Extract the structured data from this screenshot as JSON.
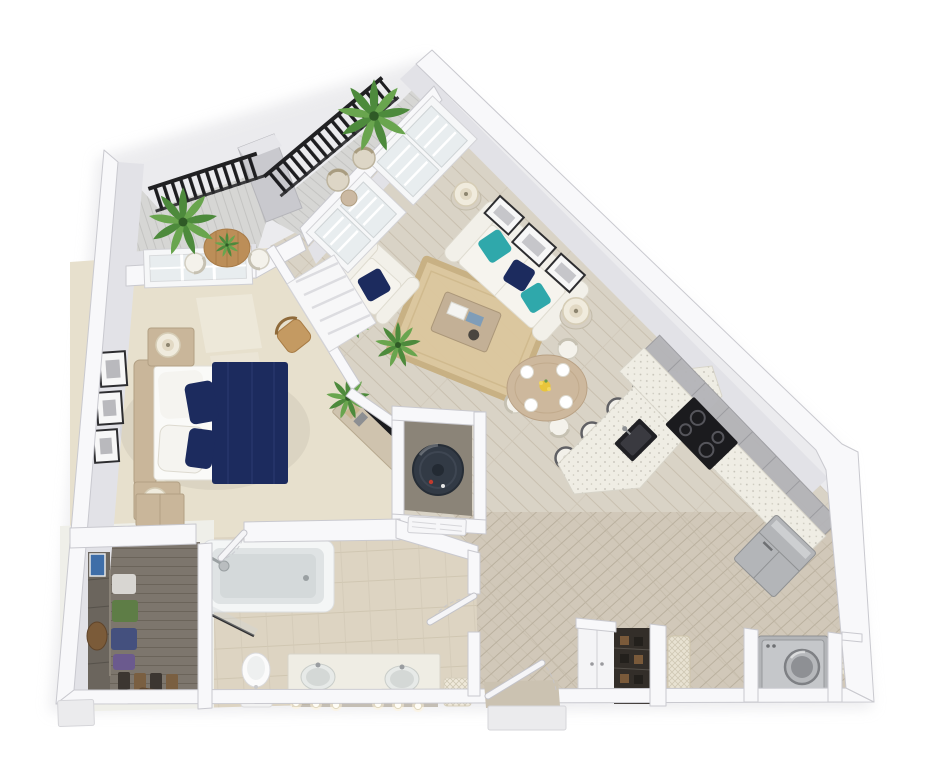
{
  "meta": {
    "description": "3D isometric floor plan render of a one-bedroom, one-bath apartment with open living, kitchen and two balconies",
    "visible_text": ""
  },
  "colors": {
    "wall": "#f8f8fa",
    "wallEdge": "#c9c9cf",
    "wallFace": "#e2e2e7",
    "floorWood": "#d9d3c6",
    "floorWoodDark": "#cbc2b1",
    "plankLine": "#c6bdac",
    "carpet": "#e7e0cd",
    "tile": "#ddd4c2",
    "balcony": "#d6d6d4",
    "closetFloor": "#7d766d",
    "rug": "#dcc79e",
    "rugBorder": "#c8b082",
    "navy": "#1c2b5e",
    "teal": "#2fa8ab",
    "sofa": "#f2f0e9",
    "woodFurn": "#c9b69a",
    "counter": "#efede4",
    "counterEdge": "#d8d5ca",
    "appliance": "#b3b5b8",
    "black": "#1b1b1e",
    "plant": "#4d8a3c",
    "plantDark": "#69a54e",
    "glass": "#e8edef",
    "railing": "#1d1d20"
  },
  "rooms": [
    {
      "id": "bedroom",
      "name": "Bedroom",
      "furniture": [
        "bed with navy duvet and white pillows",
        "2 nightstands",
        "2 table lamps",
        "3 wall frames",
        "wicker chair",
        "media console with tv",
        "dresser",
        "window",
        "louvered door",
        "2 palm plants"
      ]
    },
    {
      "id": "living-room",
      "name": "Living room",
      "furniture": [
        "white sofa",
        "2 teal pillows",
        "1 navy pillow",
        "armchair with navy pillow",
        "jute rug",
        "coffee table with books",
        "2 side tables with lamps",
        "3 wall frames",
        "palm plant",
        "french patio doors"
      ]
    },
    {
      "id": "kitchen",
      "name": "Kitchen",
      "furniture": [
        "peninsula counter with sink",
        "4 bar stools",
        "cooktop stove",
        "upper cabinets",
        "refrigerator"
      ]
    },
    {
      "id": "dining-area",
      "name": "Dining area",
      "furniture": [
        "round wood table",
        "3 chairs",
        "4 place settings",
        "yellow flowers"
      ]
    },
    {
      "id": "bathroom",
      "name": "Bathroom",
      "furniture": [
        "tub shower",
        "glass shower door",
        "shower head",
        "toilet",
        "double vanity",
        "2 round sinks",
        "6 vanity light bulbs",
        "hamper",
        "bath mat"
      ]
    },
    {
      "id": "walk-in-closet",
      "name": "Walk-in closet",
      "furniture": [
        "shelving",
        "hanging clothes",
        "shoe rack",
        "bag",
        "blue wall art"
      ]
    },
    {
      "id": "balcony-left",
      "name": "Bedroom balcony",
      "furniture": [
        "black railing",
        "round wood table",
        "2 chairs",
        "large plant",
        "table plant"
      ]
    },
    {
      "id": "balcony-right",
      "name": "Living room balcony",
      "furniture": [
        "black railing",
        "2 wicker chairs",
        "side table",
        "large plant"
      ]
    },
    {
      "id": "entry",
      "name": "Entry",
      "furniture": [
        "front door",
        "exterior step"
      ]
    },
    {
      "id": "laundry",
      "name": "Laundry / storage",
      "furniture": [
        "storage cabinet",
        "shoe closet",
        "2 woven laundry baskets",
        "washer"
      ]
    },
    {
      "id": "utility-closet",
      "name": "Utility closet",
      "furniture": [
        "water heater",
        "louvered door"
      ]
    }
  ],
  "counts": {
    "bar_stools": 4,
    "vanity_lights": 6,
    "bedroom_frames": 3,
    "living_frames": 3,
    "dining_chairs": 3
  }
}
